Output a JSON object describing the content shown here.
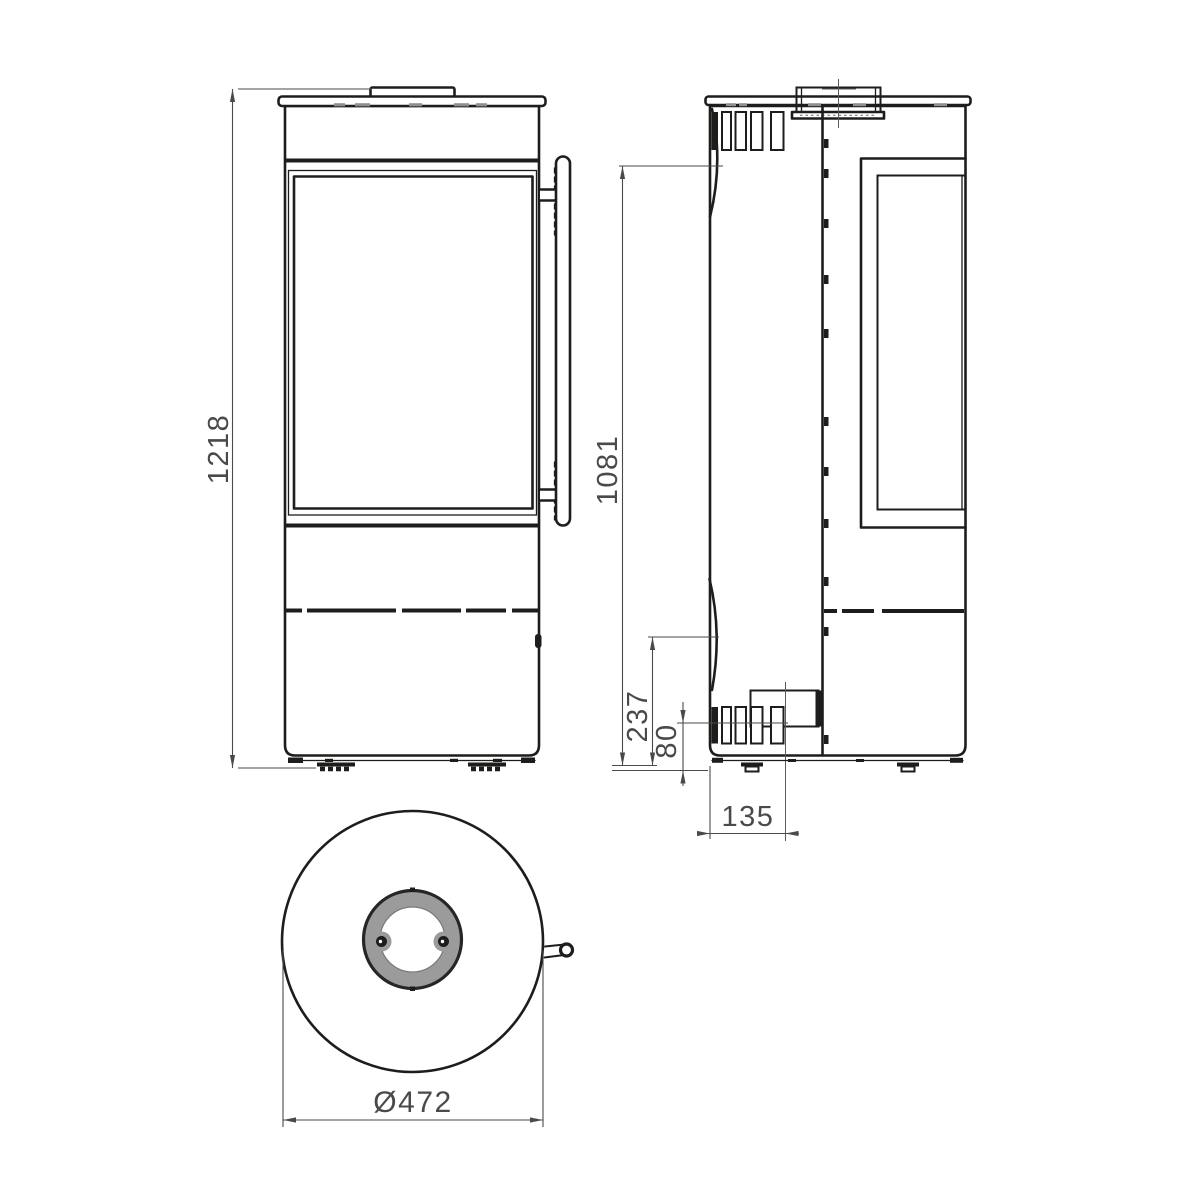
{
  "drawing": {
    "colors": {
      "line": "#1d1d1b",
      "dimension": "#4a4a4a",
      "flue_ring_fill": "#9b9b9b",
      "background": "#ffffff"
    },
    "dimensions": {
      "front_overall_height": "1218",
      "side_door_top_height": "1081",
      "side_door_bottom_height": "237",
      "side_air_inlet_center_height": "80",
      "side_air_inlet_offset": "135",
      "bottom_diameter": "Ø472"
    }
  }
}
